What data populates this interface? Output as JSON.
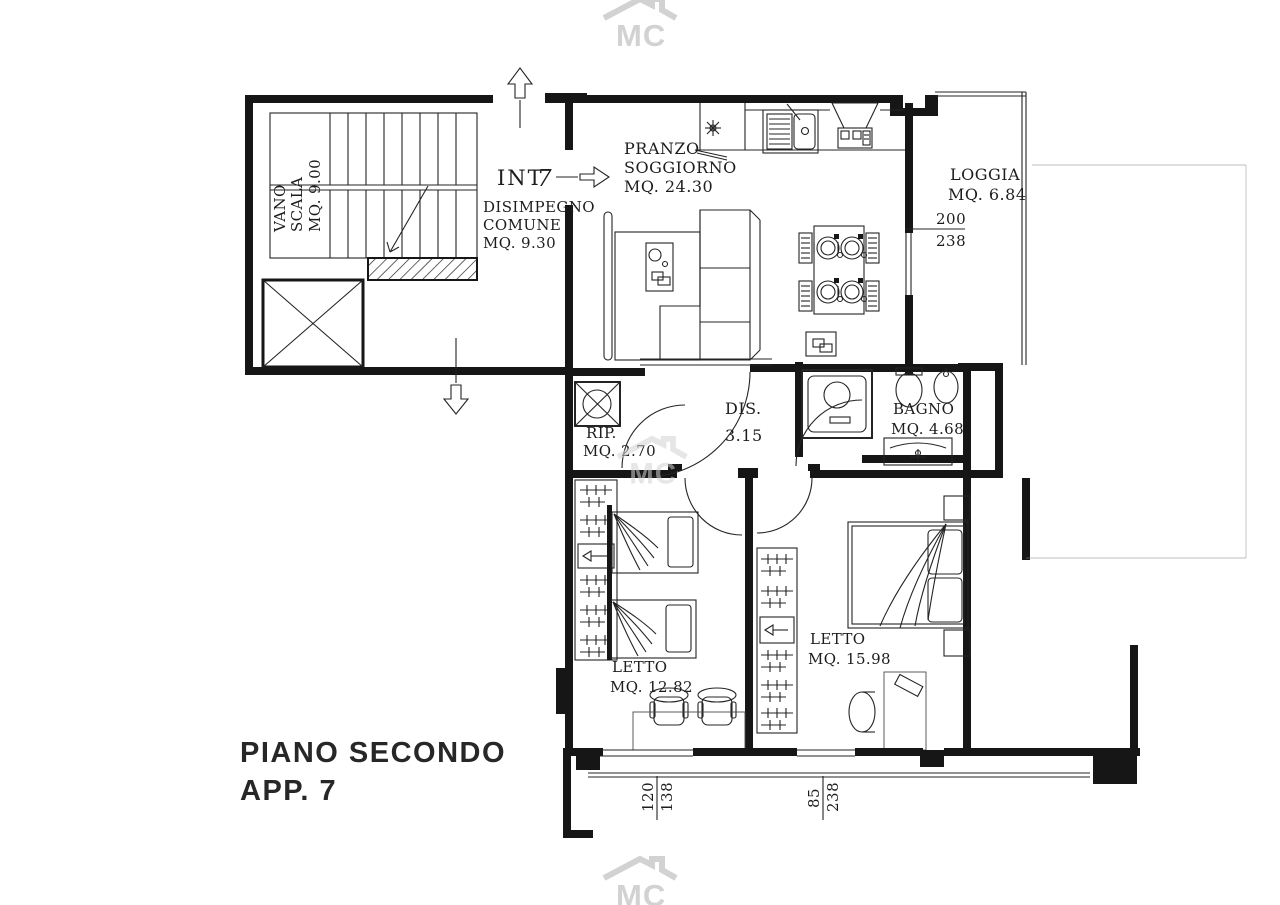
{
  "watermark": {
    "text": "MC"
  },
  "title": {
    "line1": "PIANO  SECONDO",
    "line2": "APP.  7"
  },
  "entry": {
    "label": "INT",
    "number": "7"
  },
  "rooms": {
    "vano_scala": {
      "line1": "VANO",
      "line2": "SCALA",
      "area": "MQ. 9.00"
    },
    "disimpegno_comune": {
      "line1": "DISIMPEGNO",
      "line2": "COMUNE",
      "area": "MQ. 9.30"
    },
    "pranzo_soggiorno": {
      "line1": "PRANZO",
      "line2": "SOGGIORNO",
      "area": "MQ. 24.30"
    },
    "loggia": {
      "name": "LOGGIA",
      "area": "MQ. 6.84"
    },
    "ripostiglio": {
      "name": "RIP.",
      "area": "MQ. 2.70"
    },
    "disimpegno": {
      "name": "DIS.",
      "area": "3.15"
    },
    "bagno": {
      "name": "BAGNO",
      "area": "MQ. 4.68"
    },
    "letto_doppio": {
      "name": "LETTO",
      "area": "MQ. 12.82"
    },
    "letto_matrimoniale": {
      "name": "LETTO",
      "area": "MQ. 15.98"
    }
  },
  "dimensions": {
    "loggia_door": {
      "top": "200",
      "bottom": "238"
    },
    "window_left": {
      "top": "120",
      "bottom": "138"
    },
    "window_right": {
      "top": "85",
      "bottom": "238"
    }
  },
  "colors": {
    "line": "#242424",
    "wall": "#161616",
    "watermark": "#d2d2d2",
    "paper": "#ffffff"
  }
}
